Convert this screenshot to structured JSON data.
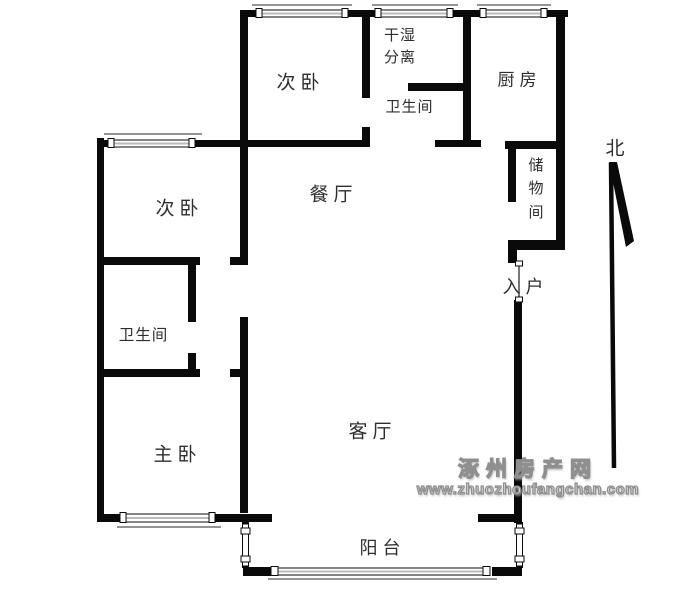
{
  "meta": {
    "type": "floor-plan",
    "background": "#ffffff"
  },
  "colors": {
    "wall": "#0a0a0a",
    "label_text": "#2e2e2e",
    "window_fill": "#ffffff",
    "window_mid": "#bbbbbb",
    "thin_line": "#555555",
    "door_line": "#777777",
    "watermark_fill": "#dedede",
    "watermark_outline": "#8f8f8f"
  },
  "compass": {
    "label": "北"
  },
  "rooms": {
    "bedroom2_top": {
      "label": "次卧"
    },
    "drywet": {
      "label": "干湿分离"
    },
    "bathroom_top": {
      "label": "卫生间"
    },
    "kitchen": {
      "label": "厨房"
    },
    "storage": {
      "label": "储物间"
    },
    "dining": {
      "label": "餐厅"
    },
    "entry": {
      "label": "入户"
    },
    "bedroom2_left": {
      "label": "次卧"
    },
    "bathroom_left": {
      "label": "卫生间"
    },
    "master": {
      "label": "主卧"
    },
    "living": {
      "label": "客厅"
    },
    "balcony": {
      "label": "阳台"
    }
  },
  "watermark": {
    "site_name": "涿州房产网",
    "site_url": "www.zhuozhoufangchan.com"
  }
}
